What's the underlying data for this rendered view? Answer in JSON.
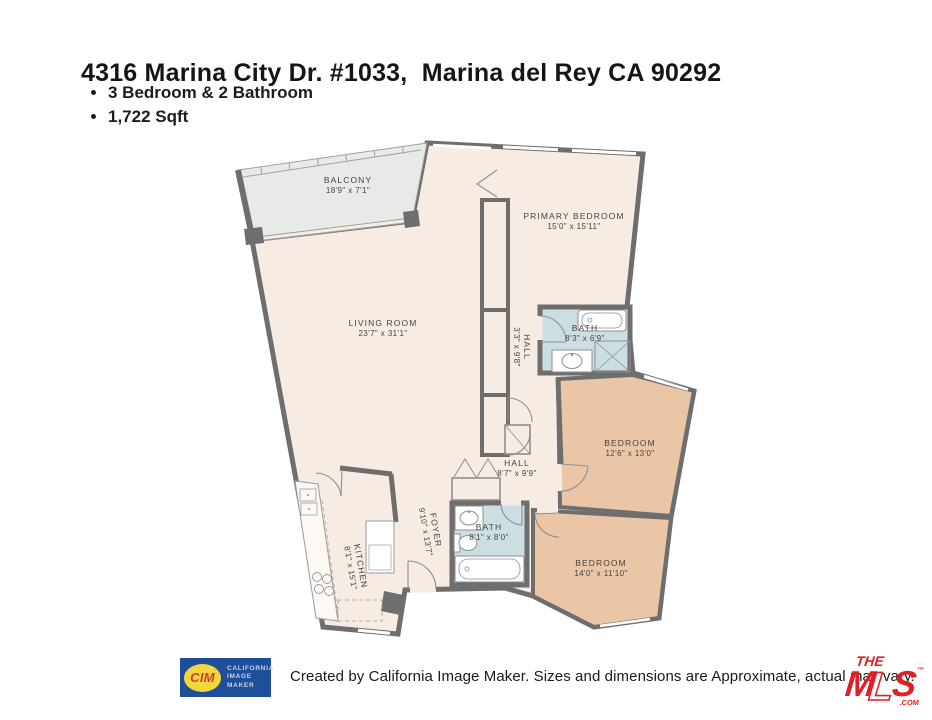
{
  "page": {
    "title": "4316 Marina City Dr. #1033,  Marina del Rey CA 90292",
    "bullets": [
      "3 Bedroom & 2 Bathroom",
      "1,722 Sqft"
    ]
  },
  "floorplan": {
    "rooms": [
      {
        "id": "balcony",
        "name": "BALCONY",
        "dims": "18'9\" x 7'1\""
      },
      {
        "id": "primary-bedroom",
        "name": "PRIMARY BEDROOM",
        "dims": "15'0\" x 15'11\""
      },
      {
        "id": "living-room",
        "name": "LIVING ROOM",
        "dims": "23'7\" x 31'1\""
      },
      {
        "id": "hall-upper",
        "name": "HALL",
        "dims": "3'3\" x 9'8\""
      },
      {
        "id": "bath-upper",
        "name": "BATH",
        "dims": "8'3\" x 6'9\""
      },
      {
        "id": "bedroom-upper",
        "name": "BEDROOM",
        "dims": "12'6\" x 13'0\""
      },
      {
        "id": "hall-lower",
        "name": "HALL",
        "dims": "8'7\" x 9'9\""
      },
      {
        "id": "foyer",
        "name": "FOYER",
        "dims": "9'10\" x 13'7\""
      },
      {
        "id": "bath-lower",
        "name": "BATH",
        "dims": "8'1\" x 8'0\""
      },
      {
        "id": "kitchen",
        "name": "KITCHEN",
        "dims": "8'1\" x 15'1\""
      },
      {
        "id": "bedroom-lower",
        "name": "BEDROOM",
        "dims": "14'0\" x 11'10\""
      }
    ],
    "colors": {
      "wall": "#6e6e6e",
      "floor": "#f6ece4",
      "balcony": "#e8eae8",
      "bath": "#cbdfe2",
      "bedroom": "#ebc6a6",
      "line": "#8f8f8f"
    }
  },
  "footer": {
    "cim": {
      "abbr": "CIM",
      "line1": "CALIFORNIA",
      "line2": "IMAGE",
      "line3": "MAKER",
      "blue": "#1d4f9a",
      "yellow": "#f2d73c",
      "red": "#cf3a38"
    },
    "caption": "Created by California Image Maker. Sizes and dimensions are Approximate, actual may vary.",
    "mls": {
      "the": "THE",
      "m": "M",
      "l": "L",
      "s": "S",
      "tm": "™",
      "com": ".COM",
      "red": "#e01f26"
    }
  }
}
